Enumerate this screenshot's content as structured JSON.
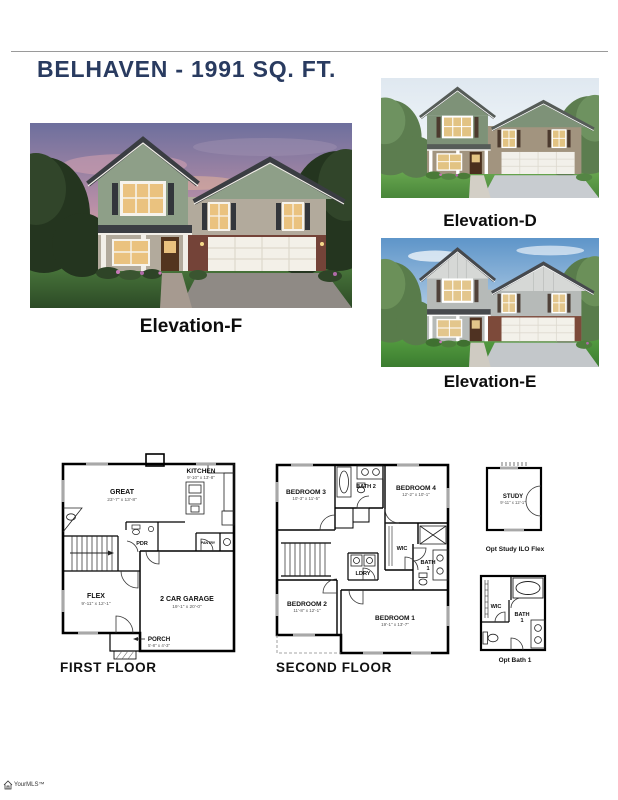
{
  "page": {
    "title": "BELHAVEN - 1991 SQ. FT.",
    "watermark": "YourMLS™",
    "watermark_icon": "house-icon"
  },
  "colors": {
    "title_navy": "#293b60",
    "caption_black": "#0d0d0d"
  },
  "elevations": {
    "f": {
      "caption": "Elevation-F"
    },
    "d": {
      "caption": "Elevation-D"
    },
    "e": {
      "caption": "Elevation-E"
    }
  },
  "first_floor": {
    "label": "FIRST FLOOR",
    "kitchen_name": "KITCHEN",
    "kitchen_dims": "9'-10\" x 13'-8\"",
    "great_name": "GREAT",
    "great_dims": "23'-7\" x 13'-8\"",
    "pdr_name": "PDR",
    "pantry_name": "PANTRY",
    "flex_name": "FLEX",
    "flex_dims": "9'-11\" x 12'-1\"",
    "garage_name": "2 CAR GARAGE",
    "garage_dims": "19'-1\" x 20'-0\"",
    "porch_name": "PORCH",
    "porch_dims": "5'-8\" x 4'-3\""
  },
  "second_floor": {
    "label": "SECOND FLOOR",
    "bedroom3_name": "BEDROOM 3",
    "bedroom3_dims": "10'-3\" x 11'-5\"",
    "bath2_name": "BATH 2",
    "bedroom4_name": "BEDROOM 4",
    "bedroom4_dims": "12'-2\" x 10'-1\"",
    "wic_name": "WIC",
    "ldry_name": "LDRY",
    "bath1_line1": "BATH",
    "bath1_line2": "1",
    "bedroom2_name": "BEDROOM 2",
    "bedroom2_dims": "11'-8\" x 12'-1\"",
    "bedroom1_name": "BEDROOM 1",
    "bedroom1_dims": "19'-1\" x 13'-7\""
  },
  "opt_study": {
    "caption": "Opt Study ILO Flex",
    "study_name": "STUDY",
    "study_dims": "9'-11\" x 12'-1\""
  },
  "opt_bath": {
    "caption": "Opt Bath 1",
    "wic_name": "WIC",
    "bath1_line1": "BATH",
    "bath1_line2": "1"
  }
}
